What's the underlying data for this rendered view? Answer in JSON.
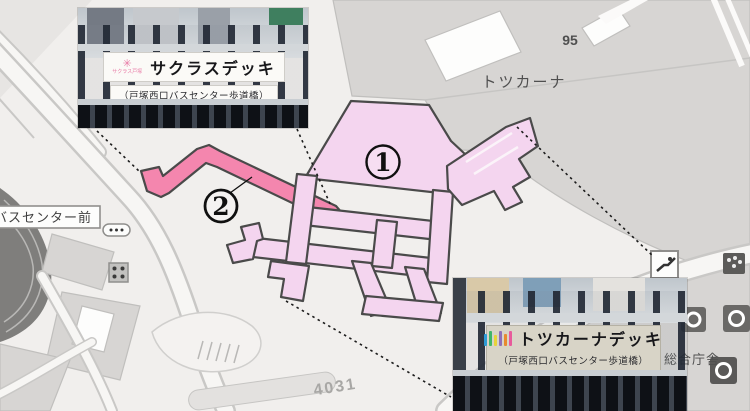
{
  "insets": {
    "sakuras": {
      "title": "サクラスデッキ",
      "subtitle": "（戸塚西口バスセンター歩道橋）",
      "logo_text": "サクラス戸塚"
    },
    "totsukana": {
      "title": "トツカーナデッキ",
      "subtitle": "（戸塚西口バスセンター歩道橋）",
      "logo_text": "totsukana"
    }
  },
  "map": {
    "labels": {
      "tower_number": "95",
      "totsukana_building": "トツカーナ",
      "bus_stop": "バスセンター前",
      "block_number": "4031",
      "gov_office": "総合庁舎"
    },
    "markers": {
      "deck1": "1",
      "deck2": "2"
    },
    "colors": {
      "bg": "#f1efed",
      "building_fill": "#d7d5d3",
      "building_stroke": "#c0bfbd",
      "deck_fill": "#f4d5ef",
      "deck_stroke": "#4a4a4a",
      "bridge_fill": "#f486ae",
      "road_casing": "#c9c8c6",
      "road_fill": "#f7f6f4",
      "label_gray": "#4f4f4f",
      "label_light": "#a8a7a5"
    }
  }
}
